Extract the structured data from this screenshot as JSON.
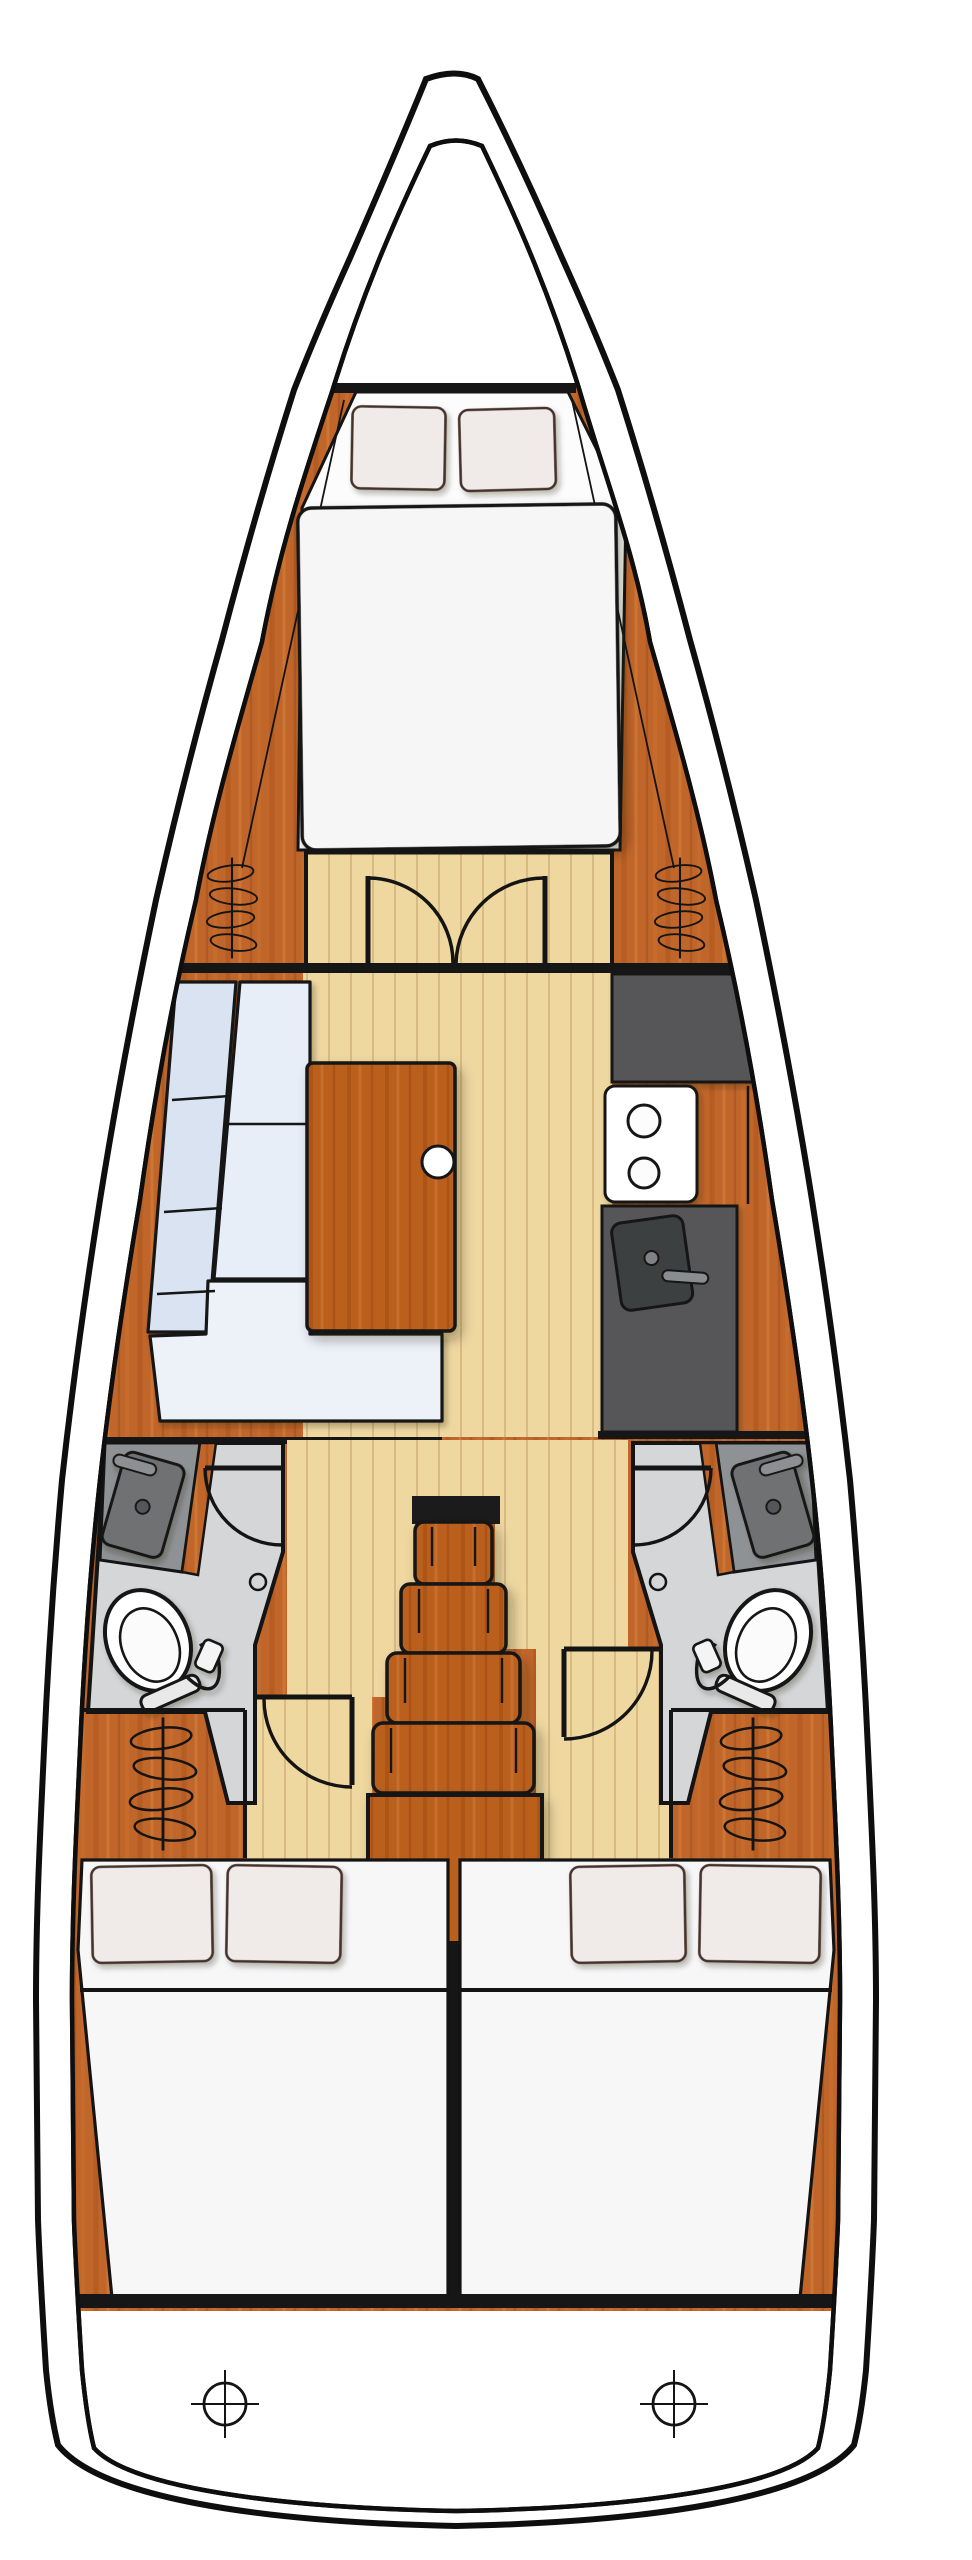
{
  "meta": {
    "title": "Sailing yacht interior layout — top-down floor plan",
    "view": "deck plan, bow up",
    "drawing_style": "illustrated brochure floor plan, no text labels"
  },
  "areas": {
    "bow": {
      "label": "Bow with anchor locker (empty forepeak)"
    },
    "forward_cabin": {
      "label": "Forward double cabin",
      "berth": "Island double berth with two pillows",
      "doors": "Double swing doors to salon",
      "lockers": {
        "port": "Hanging locker (port)",
        "starboard": "Hanging locker (starboard)"
      }
    },
    "salon": {
      "label": "Salon",
      "settee": "L-shaped settee, port side, light blue cushions",
      "table": "Wooden salon table with round knob"
    },
    "galley": {
      "label": "Galley, starboard side",
      "counter_top": "Dark worktop (forward section)",
      "stove": "Two-burner stove",
      "sink": "Sink with faucet (aft section)"
    },
    "heads": {
      "port": {
        "label": "Port head (bathroom)",
        "sink": "Vanity sink with faucet",
        "toilet": "Marine toilet",
        "door": "Door swinging into head"
      },
      "starboard": {
        "label": "Starboard head (bathroom)",
        "sink": "Vanity sink with faucet",
        "toilet": "Marine toilet",
        "door": "Door swinging into head"
      }
    },
    "companionway": {
      "label": "Companionway",
      "steps": "Four wooden steps",
      "engine_box": "Engine box below steps",
      "threshold": "Companionway threshold"
    },
    "aft_cabins": {
      "port": {
        "label": "Port aft double cabin",
        "berth": "Double berth with two pillows",
        "locker": "Hanging locker",
        "door": "Cabin entry door"
      },
      "starboard": {
        "label": "Starboard aft double cabin",
        "berth": "Double berth with two pillows",
        "locker": "Hanging locker",
        "door": "Cabin entry door"
      }
    },
    "stern": {
      "label": "Transom / lazarette",
      "fittings": "Two deck fittings (crosshair symbols)"
    }
  },
  "counts": {
    "cabins": 3,
    "heads": 2,
    "double_berths": 3,
    "pillows": 6,
    "hanging_lockers": 4,
    "stove_burners": 2,
    "companionway_steps": 4,
    "swing_doors": 6,
    "deck_fittings": 2
  },
  "icons": {
    "hanging_locker": "coil-over-rail-icon",
    "deck_fitting": "crosshair-circle-icon",
    "door": "quarter-arc-swing-icon"
  },
  "colors": {
    "outline": "#141414",
    "hull_white": "#ffffff",
    "wood": "#c1662a",
    "wood_dark_streak": "#a1511b",
    "floor_plank": "#efd7a0",
    "plank_line": "#d6b87e",
    "galley_counter": "#565758",
    "galley_sink": "#3e3f40",
    "head_floor": "#d5d6d7",
    "head_counter": "#8f9294",
    "settee_cushion": "#dce7f3",
    "mattress": "#f6f6f7",
    "pillow": "#f0eae8",
    "pillow_outline": "#44302a"
  }
}
